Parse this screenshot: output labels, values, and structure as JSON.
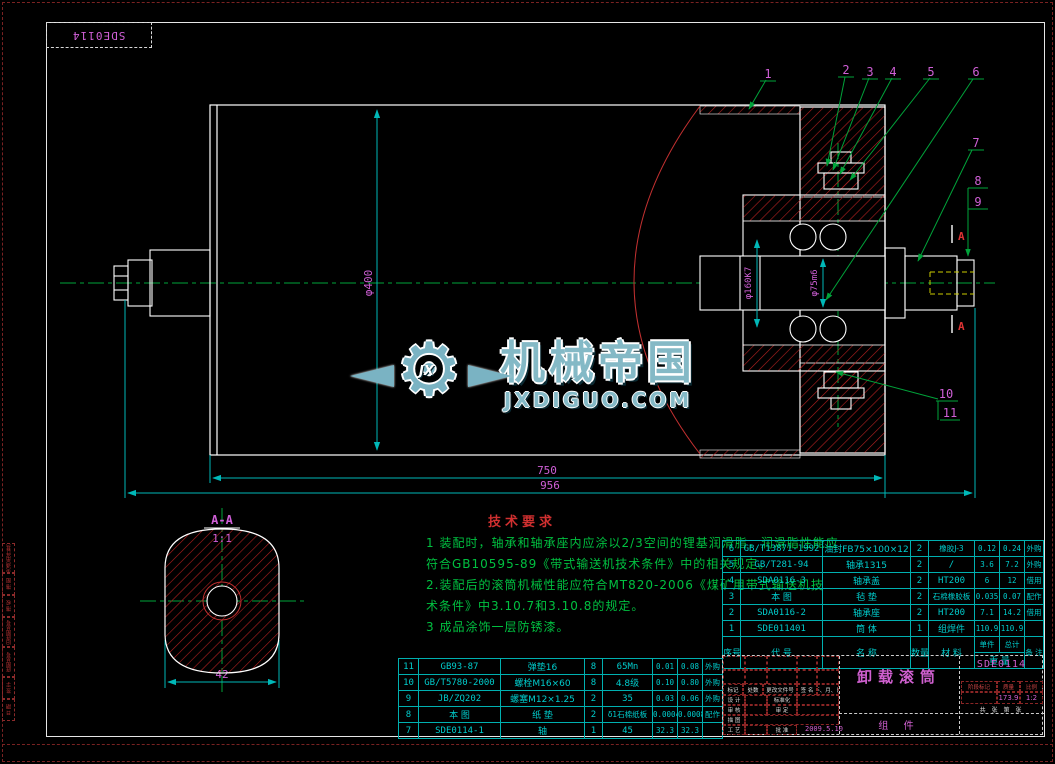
{
  "frame": {
    "top_label": "SDE0114"
  },
  "margin_labels": [
    "借(通)用件登记",
    "描 图",
    "描 校",
    "旧底图总号",
    "底图总号",
    "签 字",
    "日 期"
  ],
  "watermark": {
    "gear_text": "JX",
    "title": "机械帝国",
    "site": "JXDIGUO.COM"
  },
  "tech": {
    "title": "技术要求",
    "lines": [
      "1 装配时，轴承和轴承座内应涂以2/3空间的锂基润滑脂，润滑脂性能应",
      "符合GB10595-89《带式输送机技术条件》中的相关规定。",
      "2.装配后的滚筒机械性能应符合MT820-2006《煤矿用带式输送机技",
      "术条件》中3.10.7和3.10.8的规定。",
      "3 成品涂饰一层防锈漆。"
    ]
  },
  "dims": {
    "dia_drum": "φ400",
    "dia_hub": "φ160K7",
    "dia_shaft": "φ75m6",
    "len_inner": "750",
    "len_total": "956",
    "section_width": "42"
  },
  "section": {
    "label": "A-A",
    "scale": "1:1",
    "mark": "A"
  },
  "balloons": [
    "1",
    "2",
    "3",
    "4",
    "5",
    "6",
    "7",
    "8",
    "9",
    "10",
    "11"
  ],
  "bom_left": {
    "rows": [
      {
        "no": "11",
        "code": "GB93-87",
        "name": "弹垫16",
        "qty": "8",
        "material": "65Mn",
        "unit": "0.01",
        "total": "0.08",
        "remark": "外购"
      },
      {
        "no": "10",
        "code": "GB/T5780-2000",
        "name": "螺栓M16×60",
        "qty": "8",
        "material": "4.8级",
        "unit": "0.10",
        "total": "0.80",
        "remark": "外购"
      },
      {
        "no": "9",
        "code": "JB/ZQ202",
        "name": "螺塞M12×1.25",
        "qty": "2",
        "material": "35",
        "unit": "0.03",
        "total": "0.06",
        "remark": "外购"
      },
      {
        "no": "8",
        "code": "本 图",
        "name": "纸 垫",
        "qty": "2",
        "material": "δ1石棉纸板",
        "unit": "0.0004",
        "total": "0.0008",
        "remark": "配作"
      },
      {
        "no": "7",
        "code": "SDE0114-1",
        "name": "轴",
        "qty": "1",
        "material": "45",
        "unit": "32.3",
        "total": "32.3",
        "remark": ""
      }
    ]
  },
  "bom_right": {
    "rows": [
      {
        "no": "6",
        "code": "GB/T13871-1992",
        "name": "油封FB75×100×12",
        "qty": "2",
        "material": "橡胶J-3",
        "unit": "0.12",
        "total": "0.24",
        "remark": "外购"
      },
      {
        "no": "5",
        "code": "GB/T281-94",
        "name": "轴承1315",
        "qty": "2",
        "material": "/",
        "unit": "3.6",
        "total": "7.2",
        "remark": "外购"
      },
      {
        "no": "4",
        "code": "SDA0116-3",
        "name": "轴承盖",
        "qty": "2",
        "material": "HT200",
        "unit": "6",
        "total": "12",
        "remark": "借用"
      },
      {
        "no": "3",
        "code": "本 图",
        "name": "毡 垫",
        "qty": "2",
        "material": "石棉橡胶板",
        "unit": "0.035",
        "total": "0.07",
        "remark": "配作"
      },
      {
        "no": "2",
        "code": "SDA0116-2",
        "name": "轴承座",
        "qty": "2",
        "material": "HT200",
        "unit": "7.1",
        "total": "14.2",
        "remark": "借用"
      },
      {
        "no": "1",
        "code": "SDE011401",
        "name": "筒 体",
        "qty": "1",
        "material": "组焊件",
        "unit": "110.9",
        "total": "110.9",
        "remark": ""
      }
    ],
    "header": {
      "no": "序号",
      "code": "代  号",
      "name": "名  称",
      "qty": "数量",
      "material": "材  料",
      "unit": "单件",
      "total": "总计",
      "weight": "重  量",
      "remark": "备 注"
    }
  },
  "title_block": {
    "rev_cols": [
      "标记",
      "处数",
      "更改文件号",
      "签 名",
      "年、月、日"
    ],
    "rows": [
      {
        "left": "设 计",
        "right": "标准化"
      },
      {
        "left": "审 核",
        "right": "审 定"
      },
      {
        "left": "描 图",
        "right": ""
      },
      {
        "left": "工 艺",
        "right": "批 准"
      }
    ],
    "date": "2009.5.10",
    "product_title": "卸载滚筒",
    "product_sub": "组  件",
    "drawing_no": "SDE0114",
    "stage_label": "阶段标记",
    "mass_label": "质量",
    "scale_label": "比例",
    "mass_value": "173.9",
    "scale_value": "1:2",
    "sheet_info": "共 张  第 张"
  }
}
